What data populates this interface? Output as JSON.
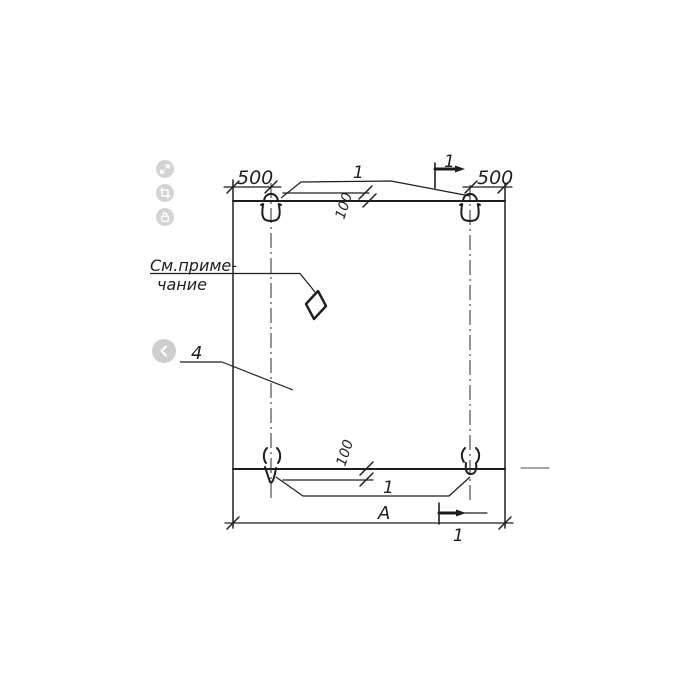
{
  "drawing": {
    "type": "technical-drawing",
    "subject": "precast panel elevation with lifting loops",
    "labels": {
      "dim_top_left": "500",
      "dim_top_right": "500",
      "dim_offset_top": "100",
      "dim_offset_bottom": "100",
      "loop_callout_top": "1",
      "loop_callout_bottom": "1",
      "section_mark_top": "1",
      "section_mark_bottom": "1",
      "panel_callout": "4",
      "dim_width": "А",
      "note_line1": "См.приме-",
      "note_line2": "чание"
    },
    "colors": {
      "ink": "#1e1e1e",
      "background": "#ffffff"
    }
  },
  "viewer_controls": {
    "buttons": [
      {
        "name": "fullscreen",
        "icon": "expand-icon"
      },
      {
        "name": "crop",
        "icon": "crop-icon"
      },
      {
        "name": "lock",
        "icon": "lock-icon"
      }
    ],
    "prev_button": {
      "name": "previous-image",
      "icon": "chevron-left-icon"
    },
    "button_color": "#d3d3d3",
    "glyph_color": "#ffffff"
  }
}
